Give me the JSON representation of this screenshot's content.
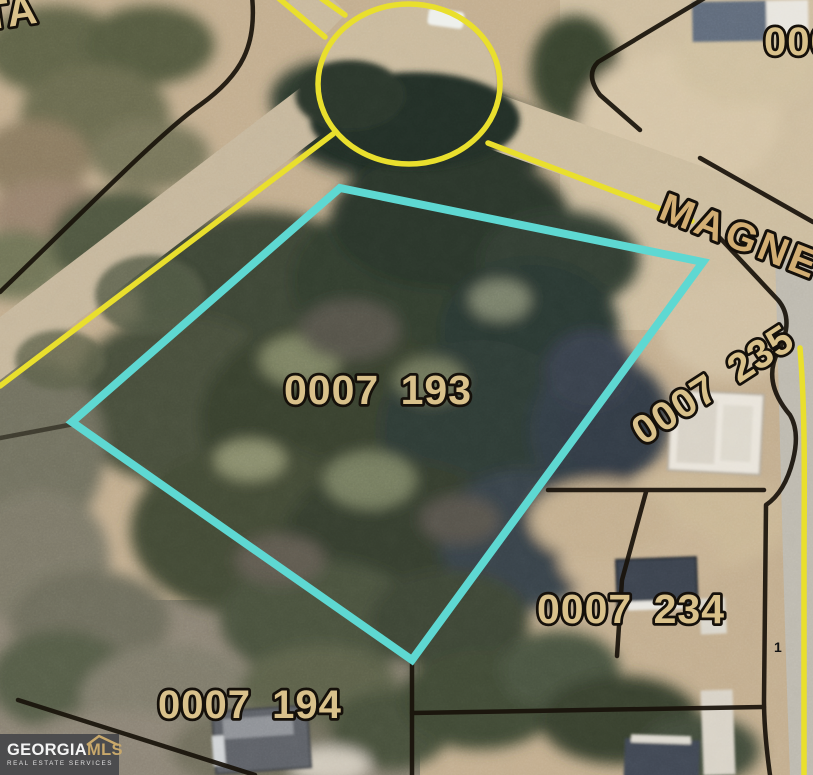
{
  "map": {
    "labels": {
      "street_top_left_partial": "TA",
      "parcel_top_right_partial": "0007",
      "street_name_partial": "MAGNE",
      "subject_parcel_id": "0007 193",
      "parcel_right_id": "0007 235",
      "parcel_bottom_right_id": "0007 234",
      "parcel_bottom_left_id": "0007 194",
      "lot_marker": "1"
    },
    "colors": {
      "subject_outline": "#5ed8d2",
      "road_paint": "#e9df2d",
      "boundary_line": "#18120a",
      "parcel_label_fill": "#d9c18b",
      "street_label_fill": "#d2ae74"
    }
  },
  "watermark": {
    "brand_primary": "GEORGIA",
    "brand_secondary": "MLS",
    "tagline": "REAL ESTATE SERVICES",
    "accent_color": "#c8a86b"
  }
}
